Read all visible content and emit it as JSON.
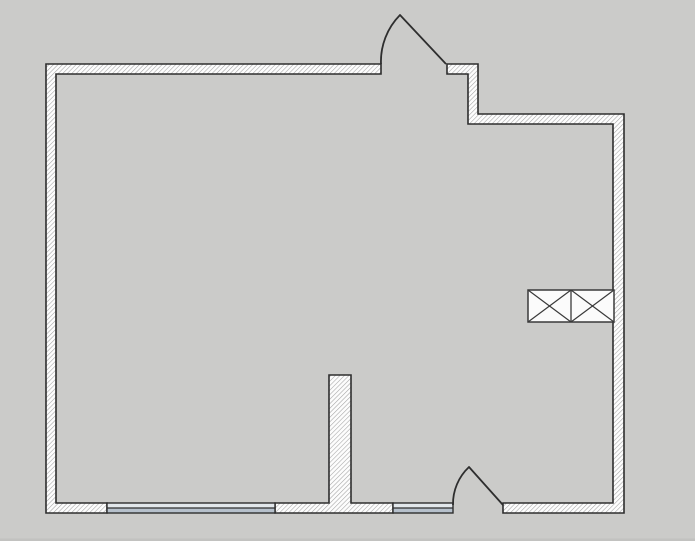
{
  "drawing": {
    "type": "floor-plan",
    "elements": {
      "walls": "exterior-hatched-walls",
      "partition": "interior-partition-stub",
      "door_top": "door-swing-top",
      "door_bottom": "door-swing-bottom-right",
      "window_left": "double-pane-window-left",
      "window_right": "double-pane-window-right",
      "cabinet": "wall-cabinet-double-x"
    }
  },
  "colors": {
    "background": "#cbcbc9",
    "edge_shadow": "#c2c2c0",
    "wall_fill": "#fdfdfd",
    "wall_hatch_line": "#a3a3a3",
    "wall_outline": "#2e2e2e",
    "door_line": "#2e2e2e",
    "window_frame": "#2e2e2e",
    "window_pane_upper": "#e2e7eb",
    "window_pane_lower": "#b6c0cb",
    "cabinet_fill": "#fbfbfb",
    "cabinet_line": "#3a3a3a"
  }
}
